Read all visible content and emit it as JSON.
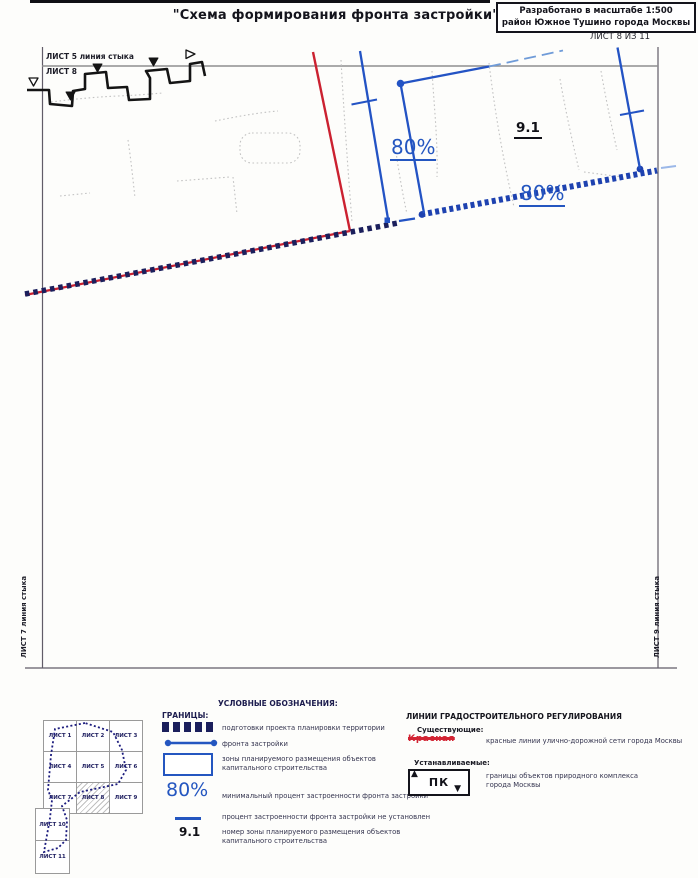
{
  "header": {
    "title": "\"Схема формирования фронта застройки\"",
    "stamp": {
      "line1": "Разработано в масштабе 1:500",
      "line2": "район Южное Тушино города Москвы"
    },
    "sheet_counter": "ЛИСТ 8 ИЗ 11"
  },
  "map": {
    "top_edge_sheet_label": "ЛИСТ 5 линия стыка",
    "top_edge_current_sheet": "ЛИСТ 8",
    "left_edge_label": "ЛИСТ 7 линия стыка",
    "right_edge_label": "ЛИСТ 9 линия стыка",
    "zone_number": "9.1",
    "min_build_percent_left": "80%",
    "min_build_percent_right": "80%"
  },
  "legend": {
    "title": "УСЛОВНЫЕ ОБОЗНАЧЕНИЯ:",
    "boundaries_header": "ГРАНИЦЫ:",
    "ppt_label": "подготовки проекта планировки территории",
    "front_label": "фронта застройки",
    "zones_label": "зоны планируемого размещения объектов капитального строительства",
    "min_percent_symbol": "80%",
    "min_percent_label": "минимальный процент застроенности фронта застройки",
    "percent_not_set_label": "процент застроенности фронта застройки не установлен",
    "zone_number_symbol": "9.1",
    "zone_number_label": "номер зоны планируемого размещения объектов капитального строительства",
    "regulation_header": "ЛИНИИ ГРАДОСТРОИТЕЛЬНОГО РЕГУЛИРОВАНИЯ",
    "existing_header": "Существующие:",
    "red_line_word": "Красная",
    "red_line_label": "красные линии улично-дорожной сети города Москвы",
    "established_header": "Устанавливаемые:",
    "pk_symbol": "ПК",
    "pk_label": "границы объектов природного комплекса города Москвы"
  },
  "index_map": {
    "sheets": [
      "ЛИСТ 1",
      "ЛИСТ 2",
      "ЛИСТ 3",
      "ЛИСТ 4",
      "ЛИСТ 5",
      "ЛИСТ 6",
      "ЛИСТ 7",
      "ЛИСТ 8",
      "ЛИСТ 9",
      "ЛИСТ 10",
      "ЛИСТ 11"
    ],
    "current_sheet": "ЛИСТ 8"
  },
  "colors": {
    "accent_blue": "#2456c0",
    "boundary_navy": "#1b1f5c",
    "red_line": "#cc2233",
    "ink": "#17171f"
  }
}
